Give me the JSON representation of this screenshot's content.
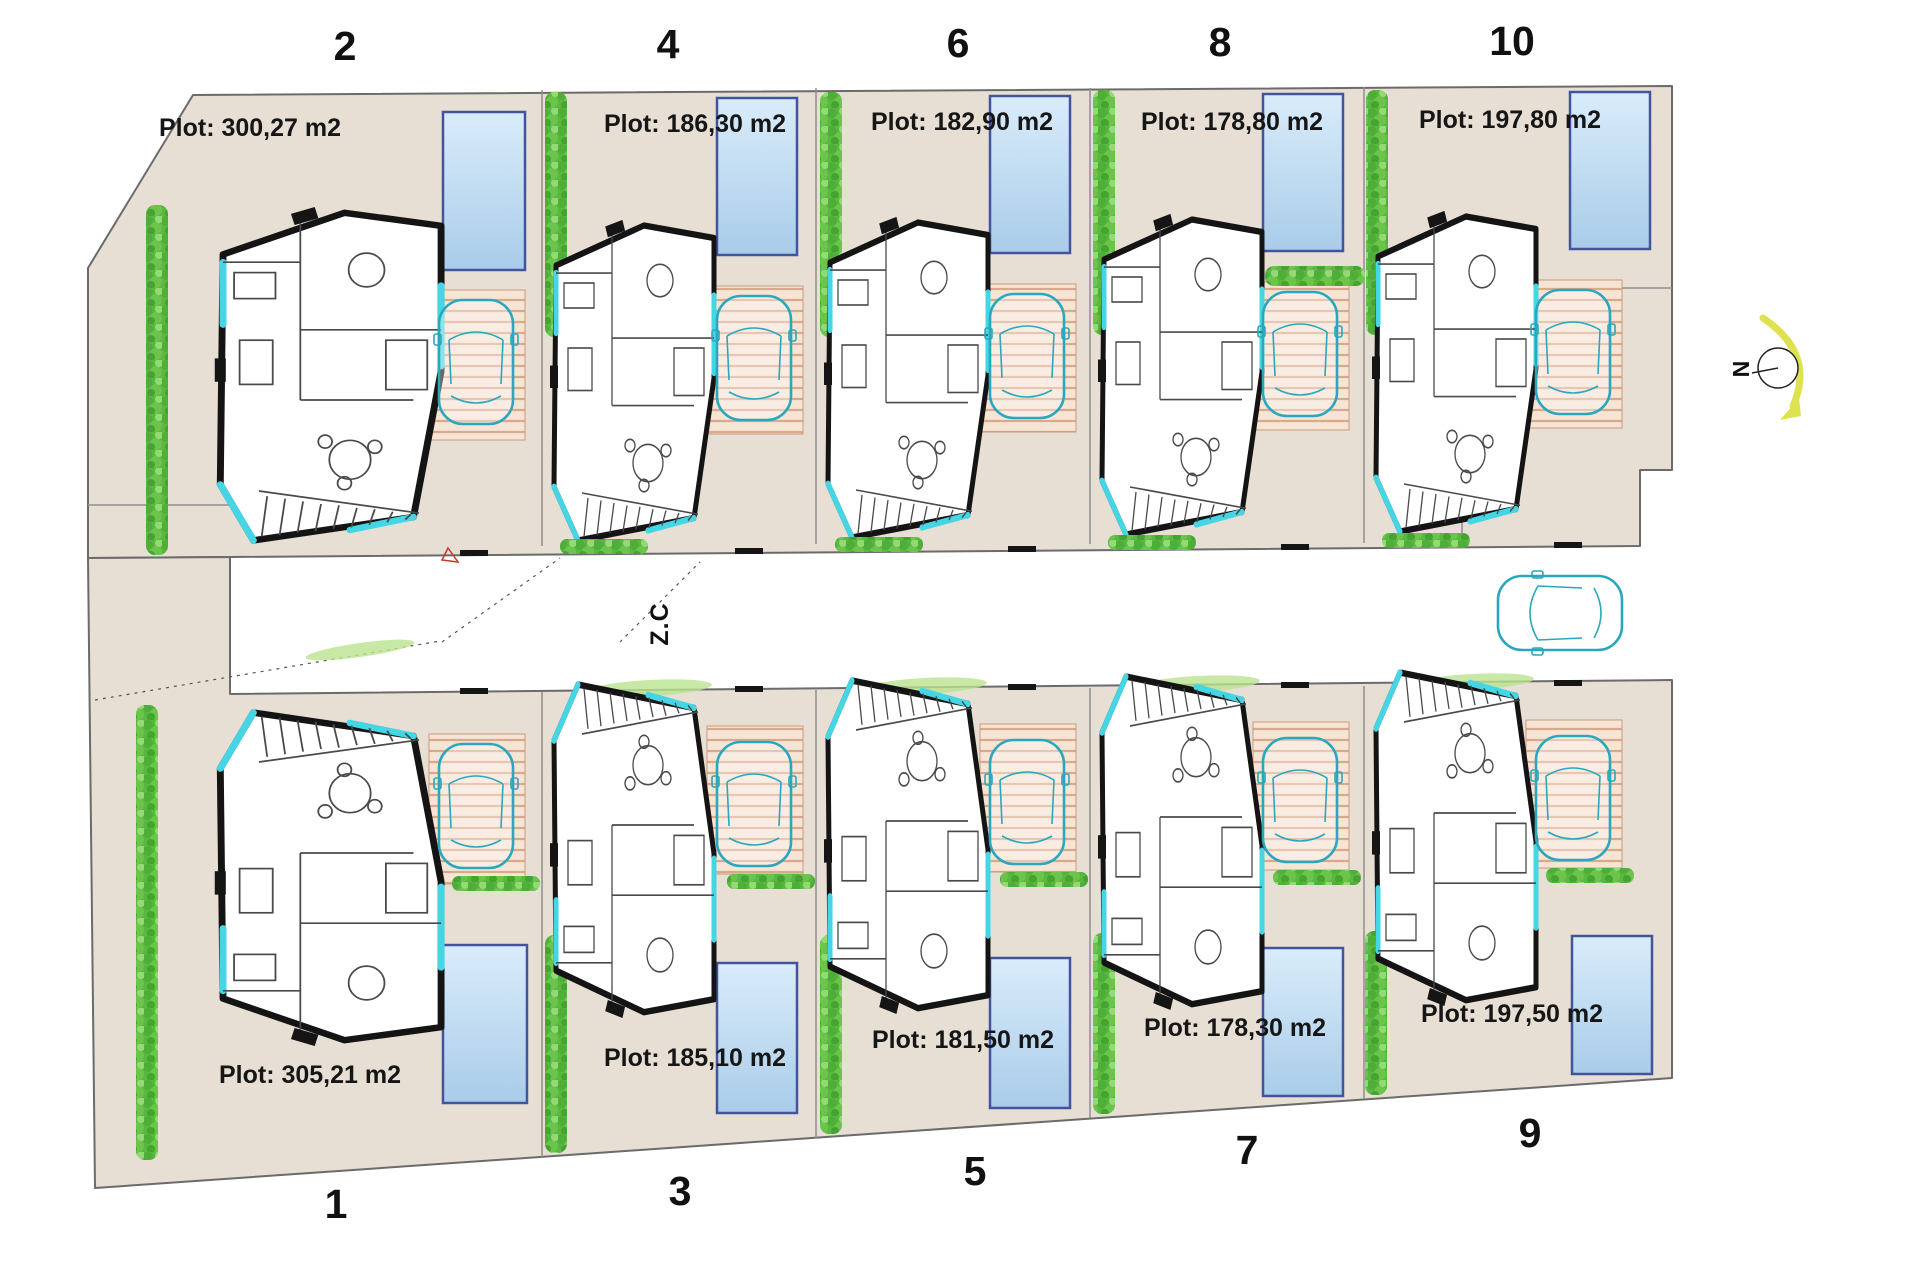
{
  "title": "Residential plots site plan",
  "street": {
    "label": "Z.C"
  },
  "compass": {
    "label": "N"
  },
  "plots": {
    "top": [
      {
        "number": "2",
        "area_label": "Plot: 300,27 m2"
      },
      {
        "number": "4",
        "area_label": "Plot: 186,30 m2"
      },
      {
        "number": "6",
        "area_label": "Plot: 182,90 m2"
      },
      {
        "number": "8",
        "area_label": "Plot: 178,80 m2"
      },
      {
        "number": "10",
        "area_label": "Plot: 197,80 m2"
      }
    ],
    "bottom": [
      {
        "number": "1",
        "area_label": "Plot: 305,21 m2"
      },
      {
        "number": "3",
        "area_label": "Plot: 185,10 m2"
      },
      {
        "number": "5",
        "area_label": "Plot: 181,50 m2"
      },
      {
        "number": "7",
        "area_label": "Plot: 178,30 m2"
      },
      {
        "number": "9",
        "area_label": "Plot: 197,50 m2"
      }
    ]
  },
  "colors": {
    "plot_fill": "#e7ded4",
    "hedge": "#58b840",
    "pool_border": "#44549c",
    "pool_fill_top": "#d9ecfa",
    "pool_fill_bottom": "#a9cce9",
    "car_outline": "#2aa7bd",
    "accent_glass": "#45d6e6",
    "north_arrow": "#dde24e",
    "garage_stripe": "#d9a98b"
  }
}
